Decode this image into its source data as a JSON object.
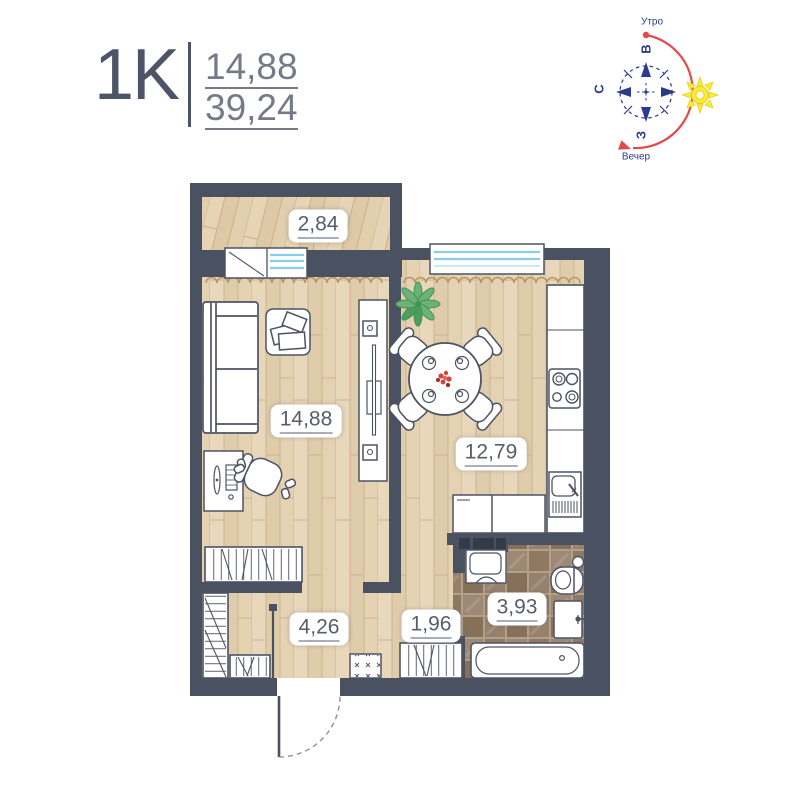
{
  "header": {
    "apartment_type": "1K",
    "living_area": "14,88",
    "total_area": "39,24"
  },
  "compass": {
    "morning": "Утро",
    "evening": "Вечер",
    "east": "В",
    "north": "С",
    "west": "З"
  },
  "rooms": {
    "balcony": "2,84",
    "living": "14,88",
    "kitchen": "12,79",
    "hallway": "4,26",
    "corridor": "1,96",
    "bathroom": "3,93"
  },
  "colors": {
    "wall": "#4a5161",
    "wood": "#e8d7ba",
    "tile": "#8f7963",
    "compass_blue": "#2c3a8c",
    "sun_arc_red": "#e54848",
    "sun_yellow": "#f7ec3b",
    "window_blue": "#8ccbe9",
    "label_text": "#575d6c"
  }
}
